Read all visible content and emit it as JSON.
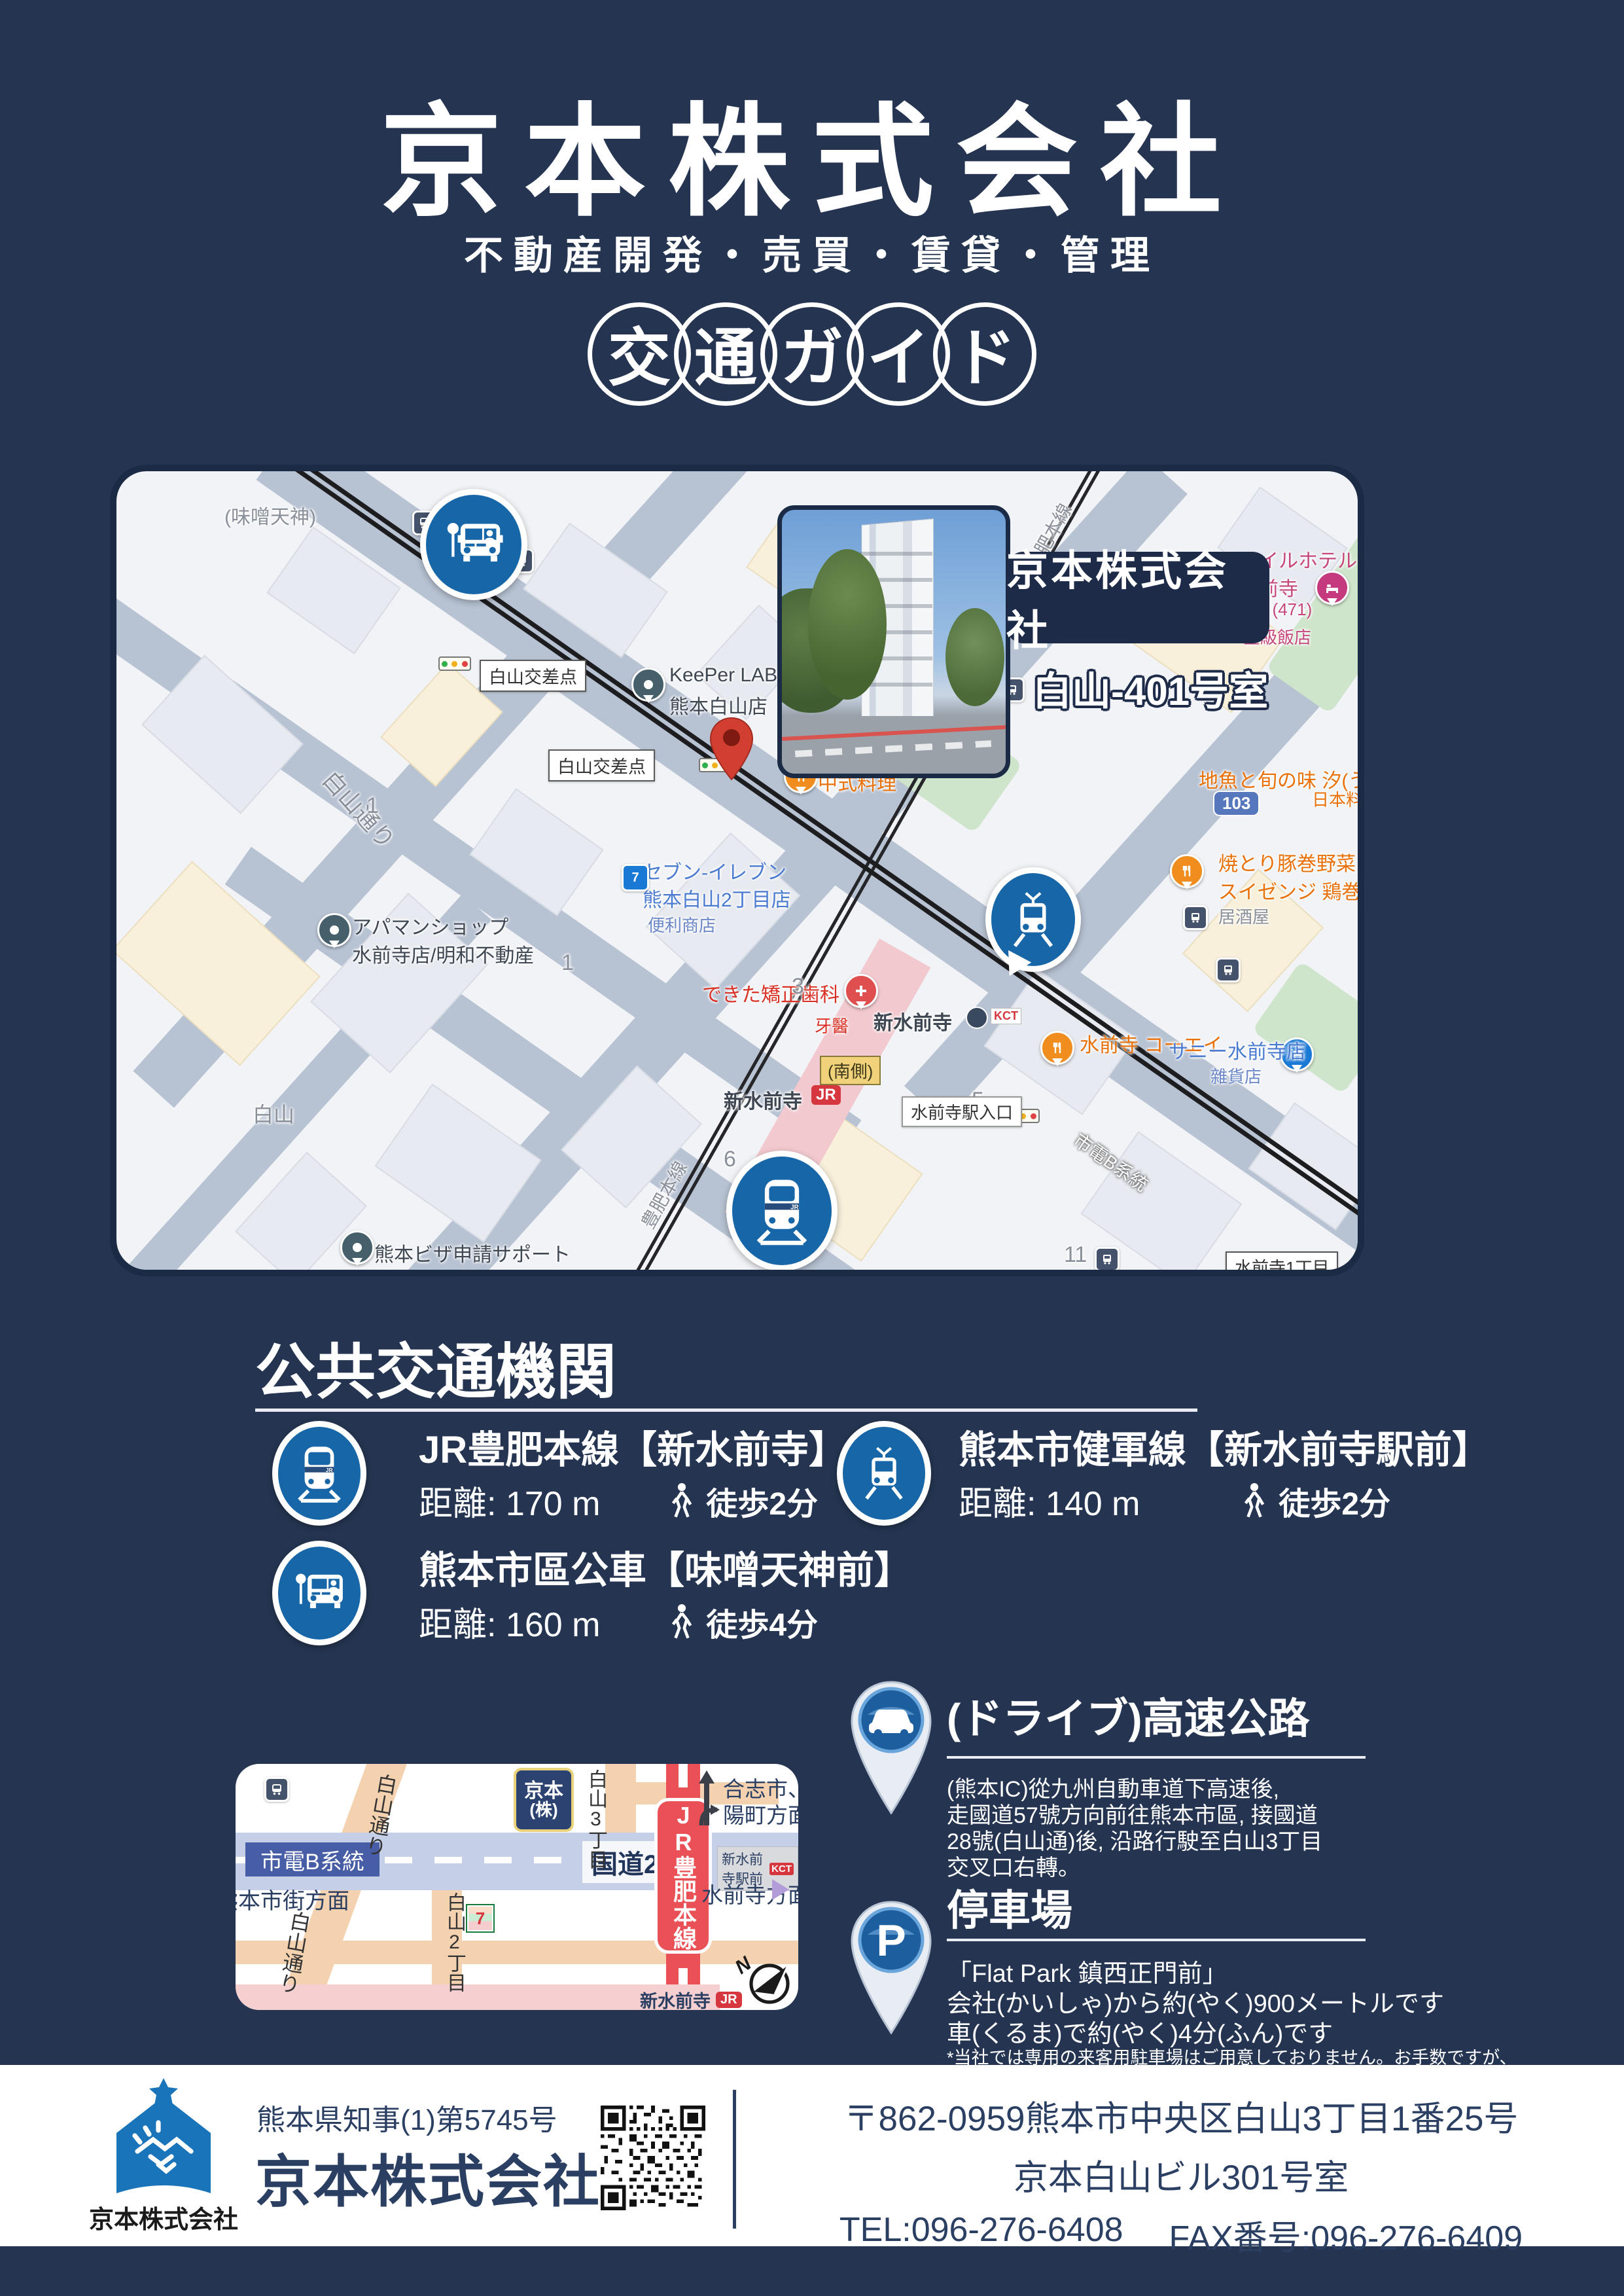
{
  "colors": {
    "page_bg": "#253551",
    "accent_blue": "#1766a8",
    "map_border": "#1c2b45",
    "jr_red": "#ea5157",
    "footer_navy": "#2b3f63",
    "pin_red": "#d23f31"
  },
  "header": {
    "title": "京本株式会社",
    "subtitle": "不動産開発・売買・賃貸・管理",
    "badge_chars": [
      "交",
      "通",
      "ガ",
      "イ",
      "ド"
    ]
  },
  "map": {
    "company": "京本株式会社",
    "room": "白山-401号室",
    "labels": {
      "misotenjin": "(味噌天神)",
      "kosaten1": "白山交差点",
      "kosaten2": "白山交差点",
      "hakusan_dori": "白山通り",
      "keeper1": "KeePer LABO",
      "keeper2": "熊本白山店",
      "chuka": "中式料理",
      "seven1": "セブン-イレブン",
      "seven2": "熊本白山2丁目店",
      "seven3": "便利商店",
      "apaman1": "アパマンショップ",
      "apaman2": "水前寺店/明和不動産",
      "dekita": "できた矯正歯科",
      "dekita2": "牙醫",
      "hakusan": "白山",
      "num1a": "1",
      "num1b": "1",
      "num3": "3",
      "num5": "5",
      "num6": "6",
      "num11": "11",
      "shinsuizenji_sta": "新水前寺",
      "kct": "KCT",
      "minamigawa": "(南側)",
      "shinsuizenji_jr": "新水前寺",
      "jr": "JR",
      "iriguchi": "水前寺駅入口",
      "koei": "水前寺 コーエイ",
      "sunny1": "サニー水前寺店",
      "sunny2": "雜貨店",
      "yakitori1": "焼とり豚巻野菜",
      "yakitori2": "スイゼンジ 鶏巻",
      "yakitori3": "居酒屋",
      "route103": "103",
      "hotel1": "スマイルホテル",
      "hotel2": "水前寺",
      "hotel3": "★ (471)",
      "hotel4": "星級飯店",
      "jizakana1": "地魚と旬の味 汐(うしお)",
      "jizakana2": "日本料理",
      "visa1": "熊本ビザ申請サポート",
      "visa2": "オフィス 行政書士 井上...",
      "suizenji1": "水前寺1丁目",
      "shidenB": "市電B系統",
      "hohi1": "豊肥本線",
      "hohi2": "豊肥本線"
    }
  },
  "transit": {
    "section_title": "公共交通機関",
    "items": [
      {
        "title": "JR豊肥本線【新水前寺】",
        "distance": "距離: 170 m",
        "walk": "徒歩2分"
      },
      {
        "title": "熊本市健軍線【新水前寺駅前】",
        "distance": "距離: 140 m",
        "walk": "徒歩2分"
      },
      {
        "title": "熊本市區公車【味噌天神前】",
        "distance": "距離: 160 m",
        "walk": "徒歩4分"
      }
    ]
  },
  "minimap": {
    "kokudo28": "国道28号",
    "shidenB": "市電B系統",
    "ekimae": "新水前寺駅前",
    "kct": "KCT",
    "hakusan_dori_upper": "白山通り",
    "hakusan_dori_lower": "白山通り",
    "hakusan3": "白山3丁目",
    "hakusan2": "白山2丁目",
    "kyomoto1": "京本",
    "kyomoto2": "(株)",
    "jr_line": "JR豊肥本線",
    "goshi1": "合志市、菊",
    "goshi2": "陽町方面",
    "suizenji_homen": "水前寺方面",
    "shigai_homen": "熊本市街方面",
    "shin_suizenji": "新水前寺",
    "jr": "JR",
    "seven": "7",
    "north": "N"
  },
  "drive": {
    "title": "(ドライブ)高速公路",
    "lines": [
      "(熊本IC)從九州自動車道下高速後,",
      "走國道57號方向前往熊本市區, 接國道",
      "28號(白山通)後, 沿路行駛至白山3丁目",
      "交叉口右轉。"
    ]
  },
  "parking": {
    "title": "停車場",
    "p": "P",
    "lines": [
      "「Flat Park 鎮西正門前」",
      "会社(かいしゃ)から約(やく)900メートルです",
      "車(くるま)で約(やく)4分(ふん)です"
    ],
    "note": "*当社では専用の来客用駐車場はご用意しておりません。お手数ですが、"
  },
  "footer": {
    "license": "熊本県知事(1)第5745号",
    "company": "京本株式会社",
    "logo_label": "京本株式会社",
    "address1": "〒862-0959熊本市中央区白山3丁目1番25号",
    "address2": "京本白山ビル301号室",
    "tel": "TEL:096-276-6408",
    "fax": "FAX番号:096-276-6409"
  }
}
